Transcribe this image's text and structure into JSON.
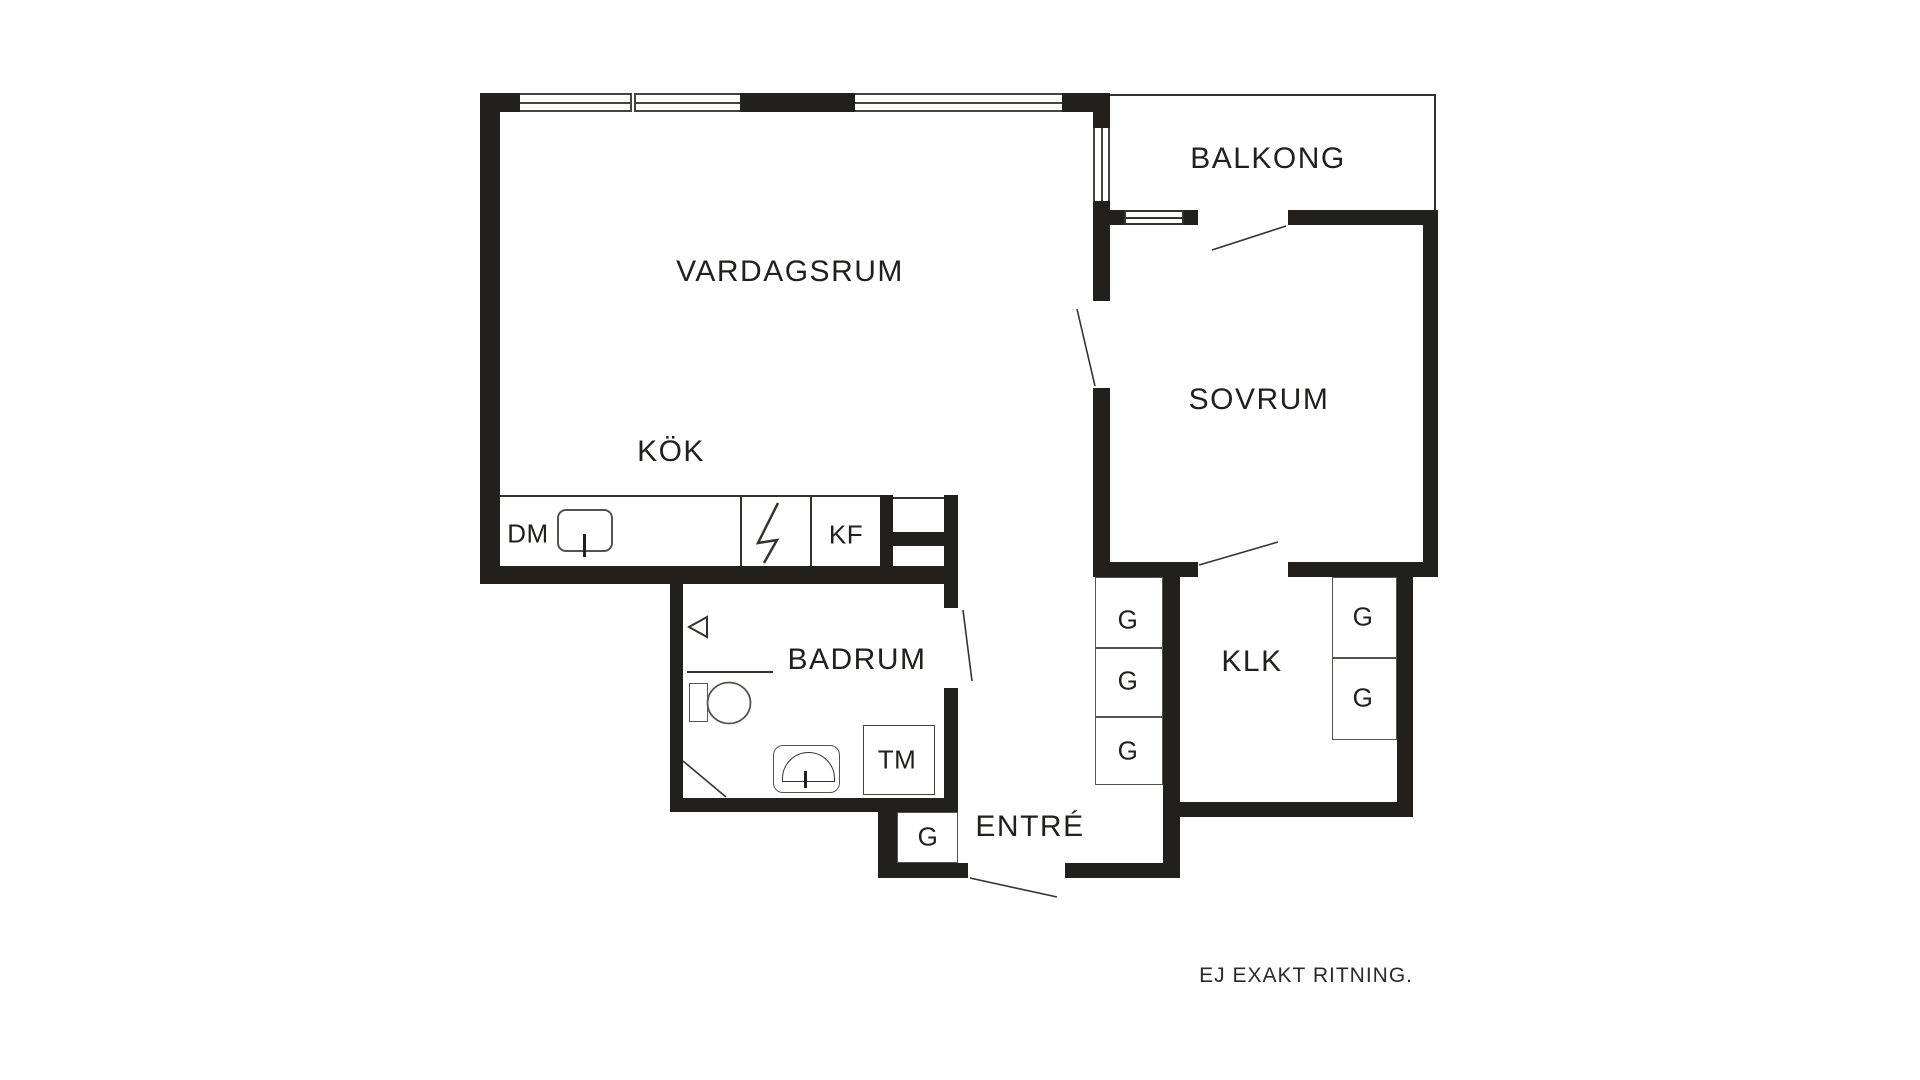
{
  "page": {
    "background": "#ffffff",
    "disclaimer": "EJ EXAKT RITNING."
  },
  "colors": {
    "wall": "#21201e",
    "line": "#35332f",
    "window_line": "#45433f"
  },
  "rooms": {
    "living_room": {
      "label": "VARDAGSRUM"
    },
    "balcony": {
      "label": "BALKONG"
    },
    "bedroom": {
      "label": "SOVRUM"
    },
    "kitchen": {
      "label": "KÖK"
    },
    "bathroom": {
      "label": "BADRUM"
    },
    "closet": {
      "label": "KLK"
    },
    "entrance": {
      "label": "ENTRÉ"
    }
  },
  "appliances": {
    "dishwasher": {
      "label": "DM"
    },
    "fridge_freezer": {
      "label": "KF"
    },
    "washing_machine": {
      "label": "TM"
    }
  },
  "wardrobes": {
    "items": [
      {
        "label": "G"
      },
      {
        "label": "G"
      },
      {
        "label": "G"
      },
      {
        "label": "G"
      },
      {
        "label": "G"
      },
      {
        "label": "G"
      }
    ]
  }
}
